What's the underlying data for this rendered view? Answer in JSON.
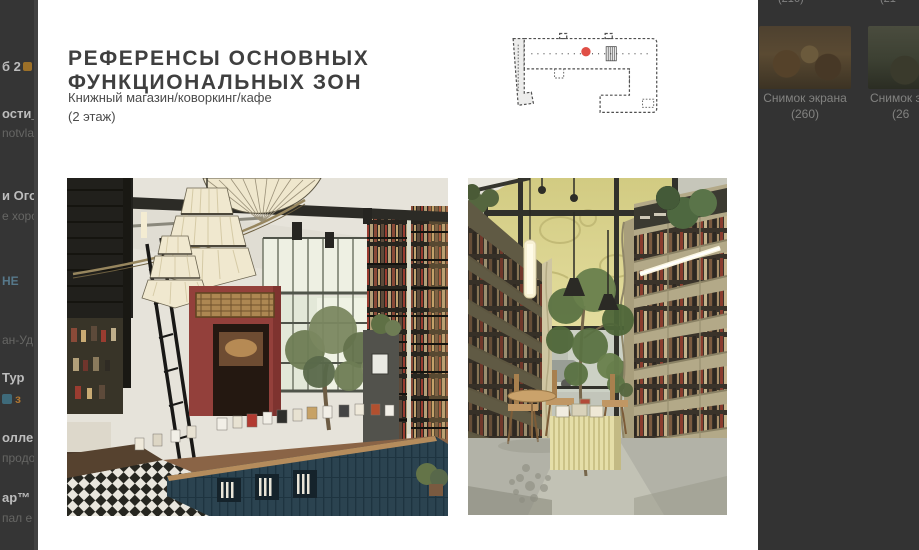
{
  "colors": {
    "overlay_bg": "#353535",
    "slide_bg": "#ffffff",
    "title_color": "#3f3f3f",
    "floorplan_marker": "#e04f46"
  },
  "sidebar_left": {
    "rows": [
      {
        "text": "б 2",
        "tail": "1"
      },
      {
        "text": "ости_"
      },
      {
        "text": "notvla"
      },
      {
        "text": "и Ого"
      },
      {
        "text": "е хоро"
      },
      {
        "text": "НЕ"
      },
      {
        "text": "ан-Уд"
      },
      {
        "text": "Тур"
      },
      {
        "text": "з"
      },
      {
        "text": "оллег"
      },
      {
        "text": "продол"
      },
      {
        "text": "ар™"
      },
      {
        "text": "пал е"
      }
    ]
  },
  "slide": {
    "title_line1": "РЕФЕРЕНСЫ ОСНОВНЫХ",
    "title_line2": "ФУНКЦИОНАЛЬНЫХ ЗОН",
    "subtitle_line1": "Книжный магазин/коворкинг/кафе",
    "subtitle_line2": "(2 этаж)",
    "floorplan": {
      "marker_color": "#e04f46"
    }
  },
  "files_panel": {
    "partial_top_labels": [
      "(216)",
      "(21"
    ],
    "items": [
      {
        "title": "Снимок экрана",
        "subtitle": "(260)"
      },
      {
        "title": "Снимок экра",
        "subtitle": "(26"
      }
    ]
  }
}
